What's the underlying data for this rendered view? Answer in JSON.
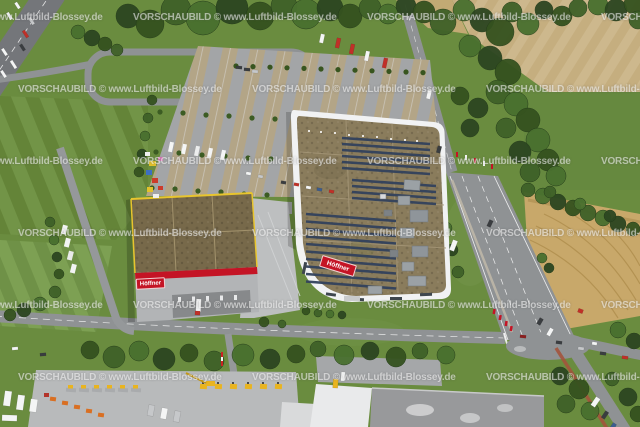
{
  "watermark": {
    "text": "VORSCHAUBILD © www.Luftbild-Blossey.de",
    "color": "rgba(255,255,255,0.55)"
  },
  "signs": {
    "main_building_sign": "Höffner",
    "warehouse_sign": "Höffner"
  },
  "colors": {
    "hoeffner_red": "#c41425",
    "solar_panel_blue": "#32415c",
    "machine_yellow": "#e9b41f",
    "roof_brown": "#8a7c5c",
    "warehouse_roof_olive": "#77694a",
    "parapet_yellow": "#e8c52e",
    "field_green": "#6a8c3f",
    "farm_tan": "#cdb88d",
    "plowed_field_gold": "#c8a86a",
    "road_gray": "#8f9294",
    "parking_gray": "#a7a9ab",
    "building_white": "#f1f2f3",
    "watermark_white": "rgba(255,255,255,0.55)"
  }
}
